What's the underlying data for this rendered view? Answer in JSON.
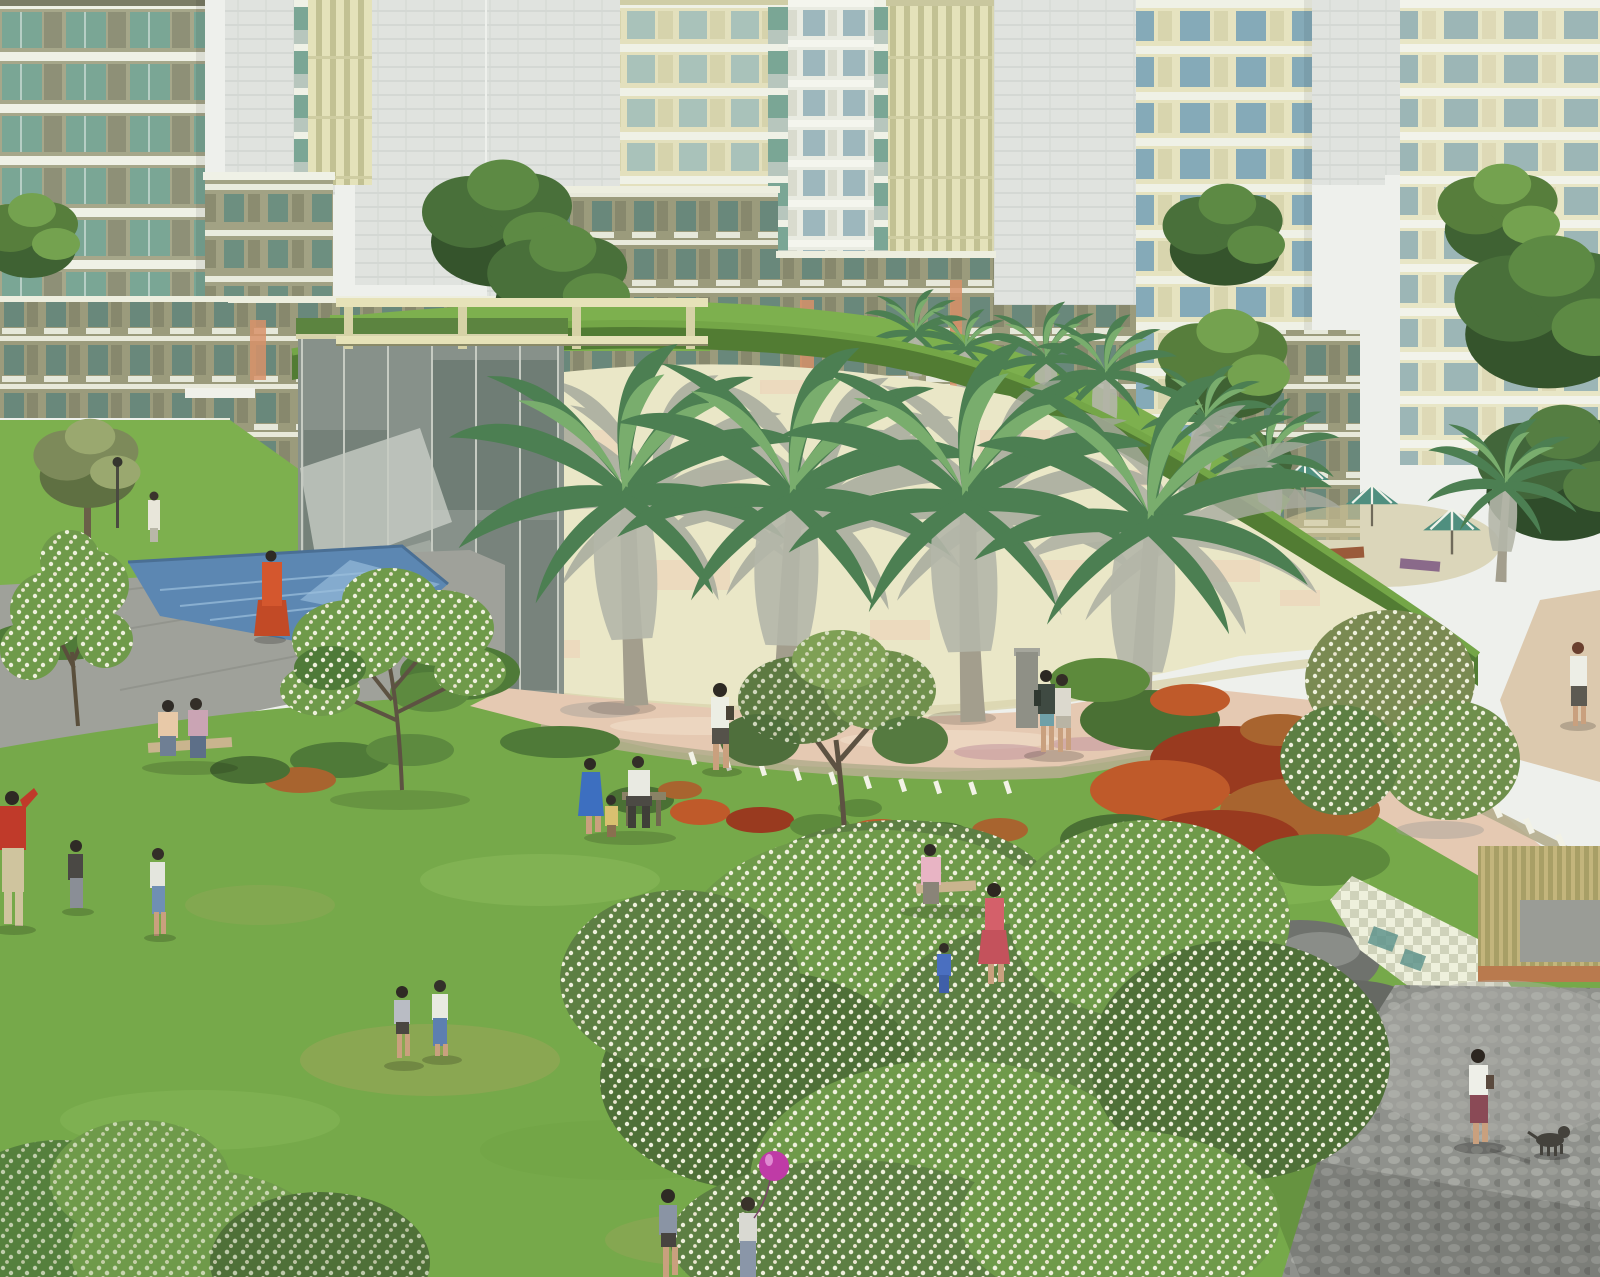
{
  "meta": {
    "type": "architectural-rendering",
    "subject": "Residential township landscape: high-rise towers, glass clubhouse pavilion, curved hedge-topped wall, fan palms, pool, flower beds and residents on a large lawn",
    "width": 1600,
    "height": 1277
  },
  "palette": {
    "sky": "#eef0ec",
    "hazeTower": "#e0e3df",
    "towerOlive": "#a6a78a",
    "slabWhite": "#eff1e6",
    "glassTeal": "#7aa695",
    "stripeLight": "#e4e2ba",
    "stripeDark": "#c2c193",
    "creamWall": "#eae7c7",
    "wallPeach": "#eccfb6",
    "hedgeGreen": "#527c33",
    "terraceLawn": "#7db04e",
    "lawn": "#76a94a",
    "poolBlue": "#5c87b2",
    "deckGray": "#9fa19a",
    "pathPink": "#e5c9b2",
    "pergola": "#e6e2b8",
    "flowerOrange": "#bf5a2a",
    "flowerRed": "#993a1f",
    "blossomWhite": "#eef0dc",
    "palmFrond": "#4c7f52",
    "balloonMagenta": "#bf3ba6",
    "terracotta": "#b97a4e",
    "cobbleGray": "#8f918c"
  },
  "scene": {
    "background": {
      "description": "Hazy white city skyline behind cream and olive apartment towers with teal glass balconies",
      "towers": [
        "olive-slab-tower-left",
        "khaki-midrise-left",
        "striped-thin-tower",
        "center-balcony-tower",
        "white-balcony-tower",
        "tall-striped-tower",
        "right-balcony-tower",
        "far-right-tower"
      ],
      "midrise_blocks": 6
    },
    "midground": {
      "glass_pavilion": "glass clubhouse wall with cream pergola and green roof terrace",
      "curved_wall": "cream curved retaining wall topped by sweeping hedge band",
      "front_palms": 4,
      "pool": "blue reflecting pool on grey paved deck",
      "umbrella_garden": "striped parasols and loungers in garden behind the wall"
    },
    "foreground": {
      "lawn": "large central lawn with worn patches",
      "flower_beds": [
        "orange-red bed along walkway",
        "large rust-red bed on right slope"
      ],
      "flowering_trees": [
        "left blossom tree",
        "center-left blossom tree",
        "small olive tree at wall",
        "giant white-blossom canopy right",
        "bottom-left blossom bush"
      ],
      "paths": [
        "pink paved walkway at wall base",
        "grey path by pool",
        "grey cobble plaza bottom right",
        "pale checker stepping path",
        "bamboo strip deck with terracotta edge"
      ],
      "people": [
        {
          "id": "woman-sari-at-pool"
        },
        {
          "id": "person-on-terrace"
        },
        {
          "id": "couple-on-bench-left"
        },
        {
          "id": "woman-walking-path"
        },
        {
          "id": "family-group-center"
        },
        {
          "id": "couple-at-wall"
        },
        {
          "id": "bench-family-right"
        },
        {
          "id": "woman-rose-dress"
        },
        {
          "id": "children-running-center"
        },
        {
          "id": "children-with-balloon"
        },
        {
          "id": "man-red-shirt-left-edge"
        },
        {
          "id": "children-left"
        },
        {
          "id": "woman-right-path"
        },
        {
          "id": "woman-on-cobble-plaza"
        },
        {
          "id": "dog-on-cobble-plaza"
        }
      ]
    }
  }
}
